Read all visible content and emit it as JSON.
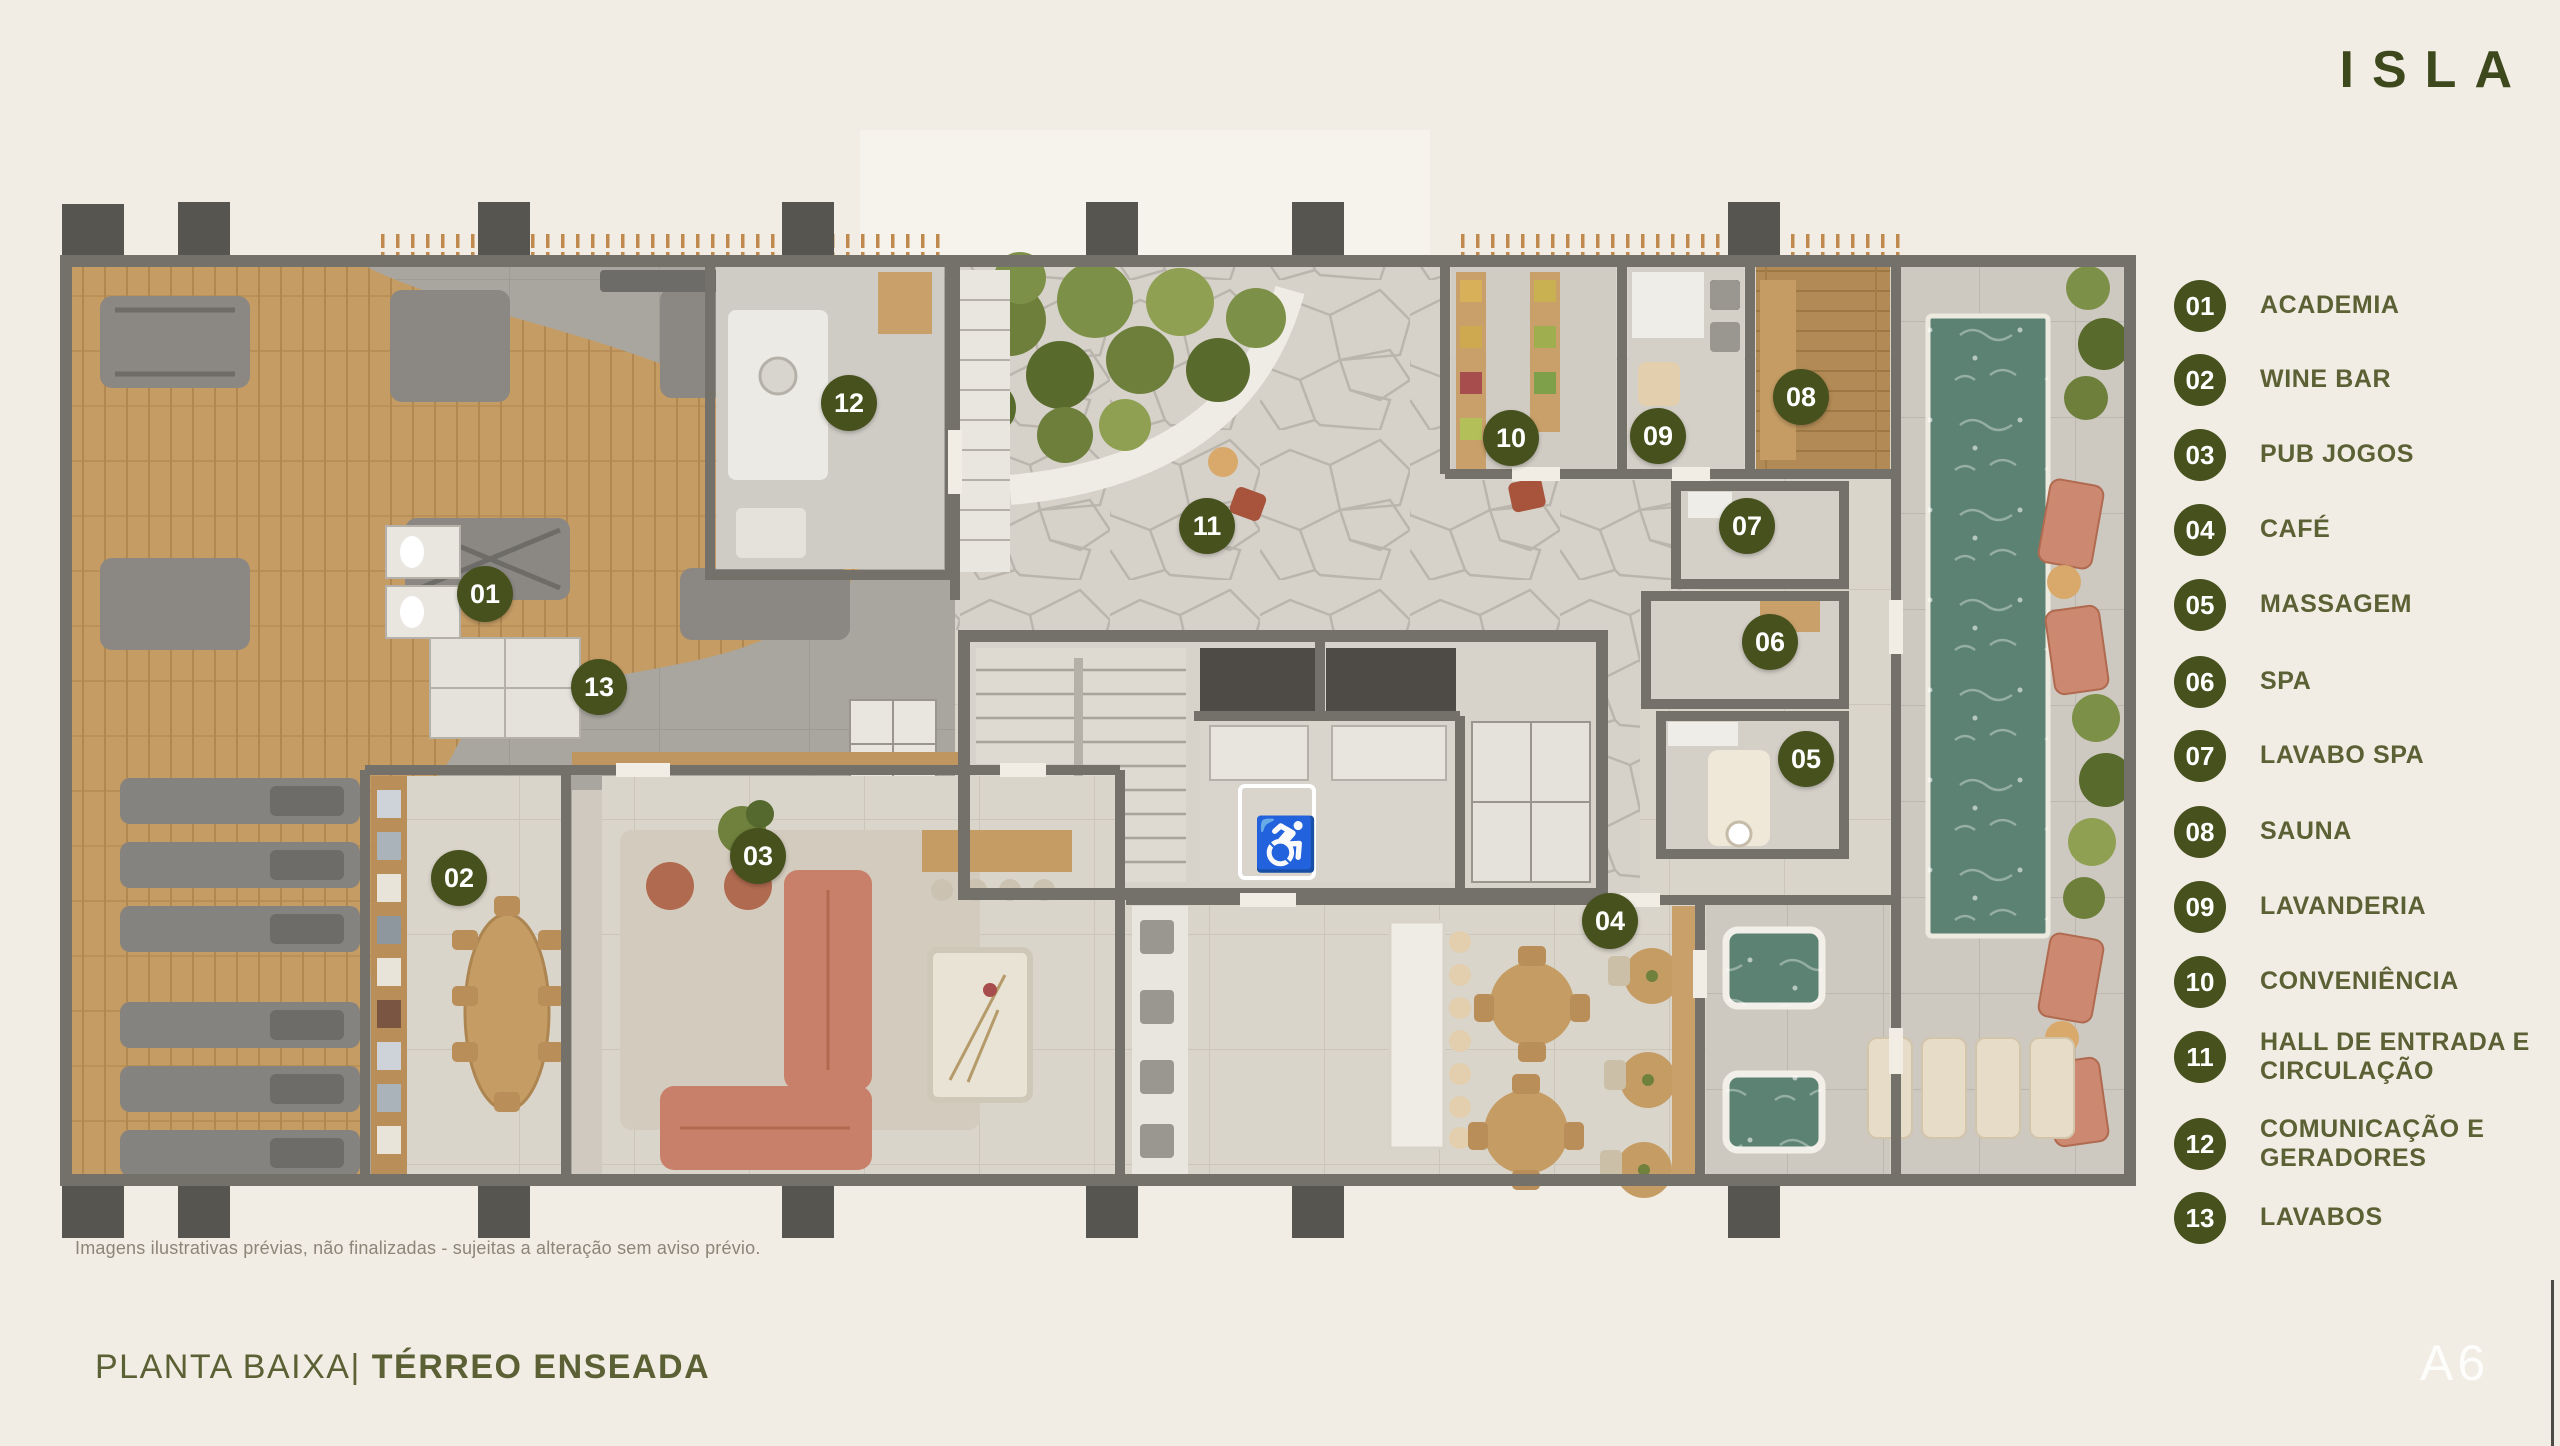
{
  "brand": {
    "logo": "ISLA"
  },
  "page": {
    "sheet_code": "A6"
  },
  "title": {
    "prefix": "PLANTA BAIXA|",
    "emphasis": "TÉRREO ENSEADA"
  },
  "footnote": "Imagens ilustrativas prévias, não finalizadas - sujeitas a alteração sem aviso prévio.",
  "icons": {
    "wheelchair": "♿"
  },
  "colors": {
    "accent": "#47511d",
    "legend_text": "#5b6134",
    "background": "#f1ede4",
    "wall": "#74716a",
    "pool_water": "#5c8273",
    "wood_floor": "#c59c64",
    "sofa_salmon": "#c9806b"
  },
  "legend": {
    "items": [
      {
        "num": "01",
        "label": "ACADEMIA"
      },
      {
        "num": "02",
        "label": "WINE BAR"
      },
      {
        "num": "03",
        "label": "PUB JOGOS"
      },
      {
        "num": "04",
        "label": "CAFÉ"
      },
      {
        "num": "05",
        "label": "MASSAGEM"
      },
      {
        "num": "06",
        "label": "SPA"
      },
      {
        "num": "07",
        "label": "LAVABO SPA"
      },
      {
        "num": "08",
        "label": "SAUNA"
      },
      {
        "num": "09",
        "label": "LAVANDERIA"
      },
      {
        "num": "10",
        "label": "CONVENIÊNCIA"
      },
      {
        "num": "11",
        "label": "HALL DE ENTRADA E CIRCULAÇÃO"
      },
      {
        "num": "12",
        "label": "COMUNICAÇÃO E GERADORES"
      },
      {
        "num": "13",
        "label": "LAVABOS"
      }
    ]
  },
  "plan": {
    "markers": [
      {
        "num": "01",
        "label": "ACADEMIA"
      },
      {
        "num": "02",
        "label": "WINE BAR"
      },
      {
        "num": "03",
        "label": "PUB JOGOS"
      },
      {
        "num": "04",
        "label": "CAFÉ"
      },
      {
        "num": "05",
        "label": "MASSAGEM"
      },
      {
        "num": "06",
        "label": "SPA"
      },
      {
        "num": "07",
        "label": "LAVABO SPA"
      },
      {
        "num": "08",
        "label": "SAUNA"
      },
      {
        "num": "09",
        "label": "LAVANDERIA"
      },
      {
        "num": "10",
        "label": "CONVENIÊNCIA"
      },
      {
        "num": "11",
        "label": "HALL DE ENTRADA E CIRCULAÇÃO"
      },
      {
        "num": "12",
        "label": "COMUNICAÇÃO E GERADORES"
      },
      {
        "num": "13",
        "label": "LAVABOS"
      }
    ]
  }
}
